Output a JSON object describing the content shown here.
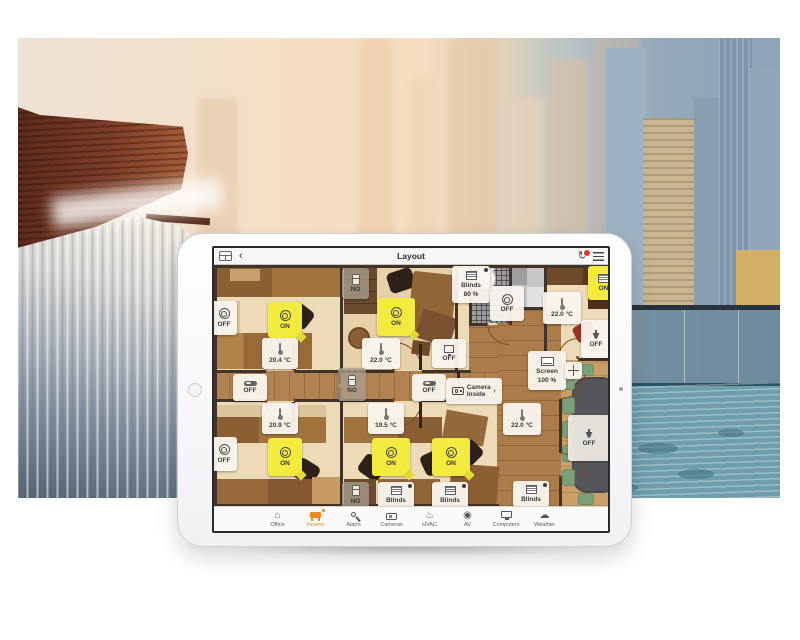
{
  "header": {
    "title": "Layout",
    "back_glyph": "‹",
    "refresh_glyph": "↻"
  },
  "tabs": [
    {
      "label": "Office",
      "glyph": "⌂"
    },
    {
      "label": "Rooms"
    },
    {
      "label": "Alarm"
    },
    {
      "label": "Cameras"
    },
    {
      "label": "HVAC",
      "glyph": "♨"
    },
    {
      "label": "AV",
      "glyph": "◉"
    },
    {
      "label": "Computers"
    },
    {
      "label": "Weather",
      "glyph": "☁"
    }
  ],
  "devices": {
    "tl_light_off": {
      "label": "OFF"
    },
    "tl_light_on": {
      "label": "ON"
    },
    "tl_temp": {
      "label": "20.4 °C"
    },
    "tm_door": {
      "label": "NO"
    },
    "tm_light_on": {
      "label": "ON"
    },
    "tm_blinds": {
      "label": "Blinds",
      "value": "80 %"
    },
    "tm_temp": {
      "label": "22.0 °C"
    },
    "tm_av": {
      "label": "OFF"
    },
    "bath_light": {
      "label": "OFF"
    },
    "kitchen_temp": {
      "label": "22.0 °C"
    },
    "tr_blinds": {
      "label": "ON"
    },
    "tr_proj": {
      "label": "OFF"
    },
    "hall_sw1": {
      "label": "OFF"
    },
    "hall_door": {
      "label": "NO"
    },
    "hall_sw2": {
      "label": "OFF"
    },
    "camera": {
      "label": "Camera",
      "value": "Inside",
      "chevron": "›"
    },
    "screen": {
      "label": "Screen",
      "value": "100 %"
    },
    "hall_temp": {
      "label": "22.0 °C"
    },
    "meet_proj": {
      "label": "OFF"
    },
    "meet_blinds": {
      "label": "Blinds"
    },
    "bl_temp": {
      "label": "20.9 °C"
    },
    "bl_light_off": {
      "label": "OFF"
    },
    "bl_light_on": {
      "label": "ON"
    },
    "bm_temp": {
      "label": "19.5 °C"
    },
    "bm_light_on1": {
      "label": "ON"
    },
    "bm_light_on2": {
      "label": "ON"
    },
    "bm_door": {
      "label": "NO"
    },
    "bm_blinds1": {
      "label": "Blinds"
    },
    "bm_blinds2": {
      "label": "Blinds"
    }
  },
  "colors": {
    "accent_orange": "#f08a1f",
    "on_yellow": "#f2ea3c",
    "alert_red": "#e0392c",
    "wood": "#b28350",
    "wall": "#3f332a"
  }
}
